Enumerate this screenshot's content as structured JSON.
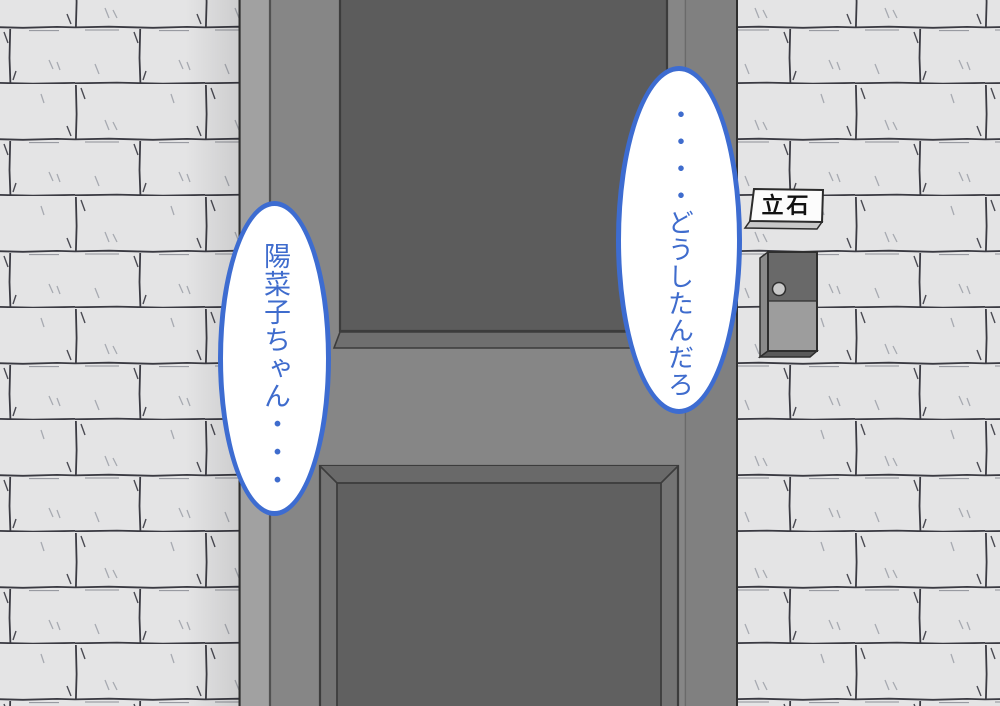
{
  "speech_bubbles": {
    "left": {
      "text": "陽菜子ちゃん・・・"
    },
    "right": {
      "text": "・・・・どうしたんだろ"
    }
  },
  "door": {
    "nameplate_label": "立石"
  },
  "colors": {
    "bubble_border": "#3d6cd1",
    "bubble_text": "#3f6ccd",
    "wall_brick": "#e4e4e5",
    "door_face": "#868686",
    "door_panel_dark": "#5c5c5c",
    "door_bevel": "#6f6f6f",
    "door_jamb": "#a1a1a1",
    "nameplate_bg": "#fcfcfc",
    "nameplate_text": "#111111",
    "doorbell_top": "#696969",
    "doorbell_body": "#9d9d9d",
    "doorbell_button": "#c9c9c9"
  }
}
